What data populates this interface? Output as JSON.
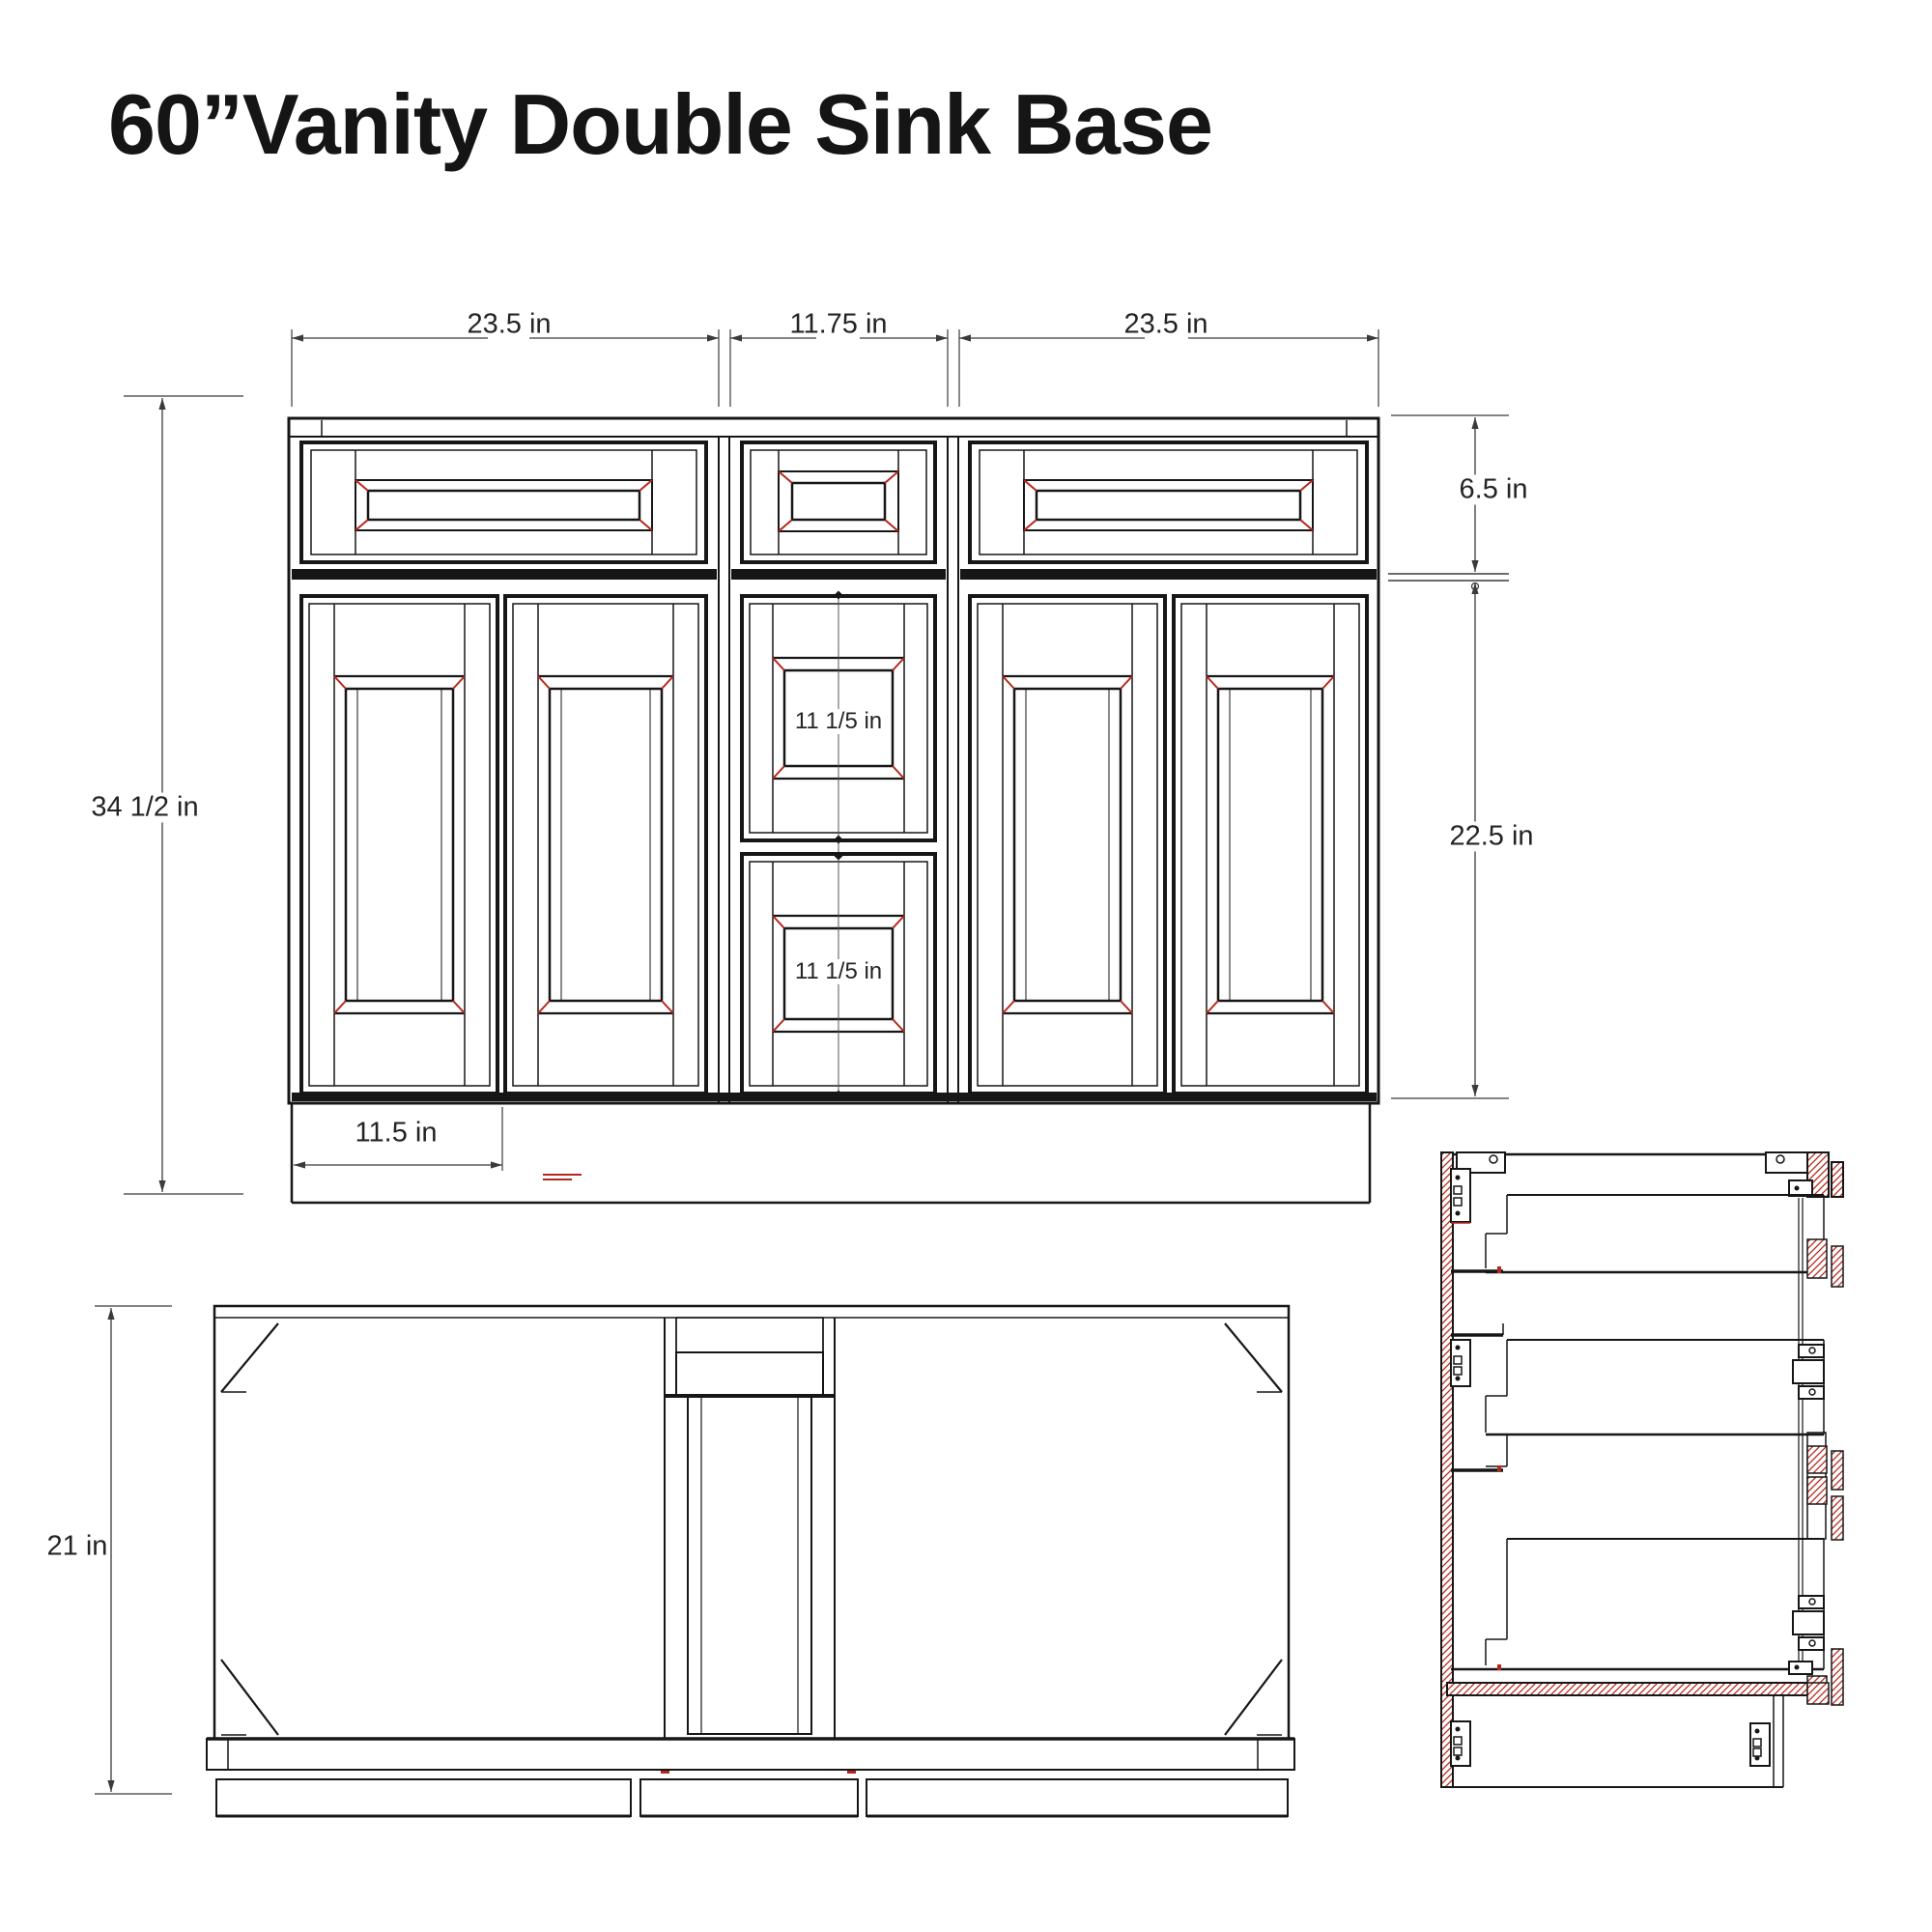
{
  "title": "60”Vanity Double Sink Base",
  "front_view": {
    "width_left": "23.5 in",
    "width_center": "11.75 in",
    "width_right": "23.5 in",
    "height_total": "34 1/2 in",
    "drawer_row_height": "6.5 in",
    "door_section_height": "22.5 in",
    "toe_kick_width": "11.5 in",
    "middle_drawer_top": "11 1/5 in",
    "middle_drawer_bottom": "11 1/5 in"
  },
  "plan_view": {
    "depth": "21 in"
  },
  "colors": {
    "line": "#161616",
    "dim_line": "#3a3a3a",
    "accent_red": "#b5271d"
  }
}
